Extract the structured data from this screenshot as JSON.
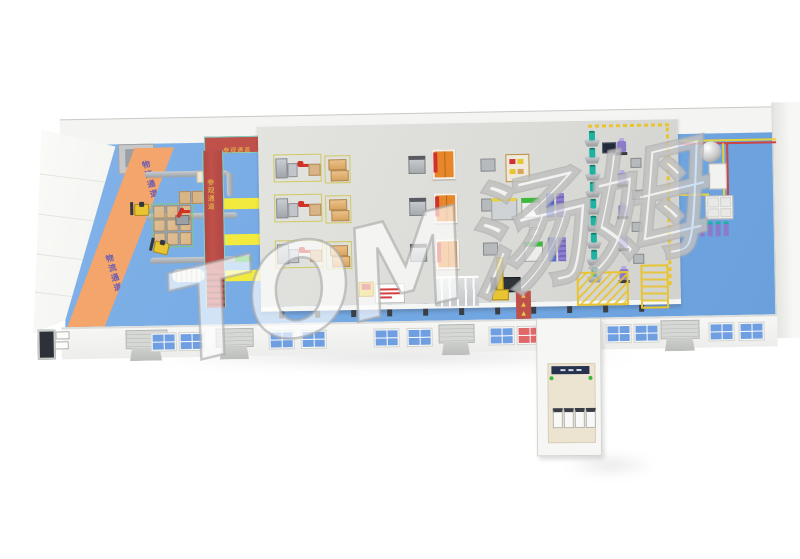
{
  "scene": {
    "description": "3D isometric factory workshop layout rendering",
    "watermark": "TOM汤姆"
  },
  "labels": {
    "logistics_aisle_upper": "物流通道",
    "logistics_aisle_lower": "物流通道",
    "visitor_walkway_top": "参观通道",
    "visitor_walkway_side": "参观通道"
  },
  "glyphs": {
    "export_arrow": "▲"
  },
  "inventory": {
    "mixer_machines": 9,
    "operator_machines": 5,
    "workstation_rows": 3,
    "pallet_stations": 3,
    "orange_cabinets": 3,
    "green_machines": 2,
    "forklifts": 2,
    "floor_pallet_grid": "3x3",
    "annex_units": 4
  },
  "colors": {
    "floor_blue": "#74a9e4",
    "aisle_orange": "#f3a56c",
    "walkway_red": "#c0504a",
    "aisle_yellow": "#f2ea3e",
    "platform_gray": "#dbdbd7",
    "wall_white": "#f4f4f2",
    "window_blue": "#6f9fe0",
    "window_red": "#e06868",
    "window_dark": "#4a4e56",
    "cabinet_orange": "#e8872a",
    "mixer_teal": "#20b2a0",
    "machine_purple": "#8a7cc8",
    "robot_red": "#d03226",
    "forklift_yellow": "#e8c430",
    "pallet_tan": "#d9b586",
    "annex_floor": "#ece3d1",
    "pipe_yellow": "#e8d23a",
    "pipe_red": "#cc4444",
    "stack_blue": "#5b6fd4",
    "stack_violet": "#8a7fd0",
    "machine_green": "#3cb83c",
    "label_purple": "#6a5bb0",
    "label_yellow": "#e8c84a"
  }
}
